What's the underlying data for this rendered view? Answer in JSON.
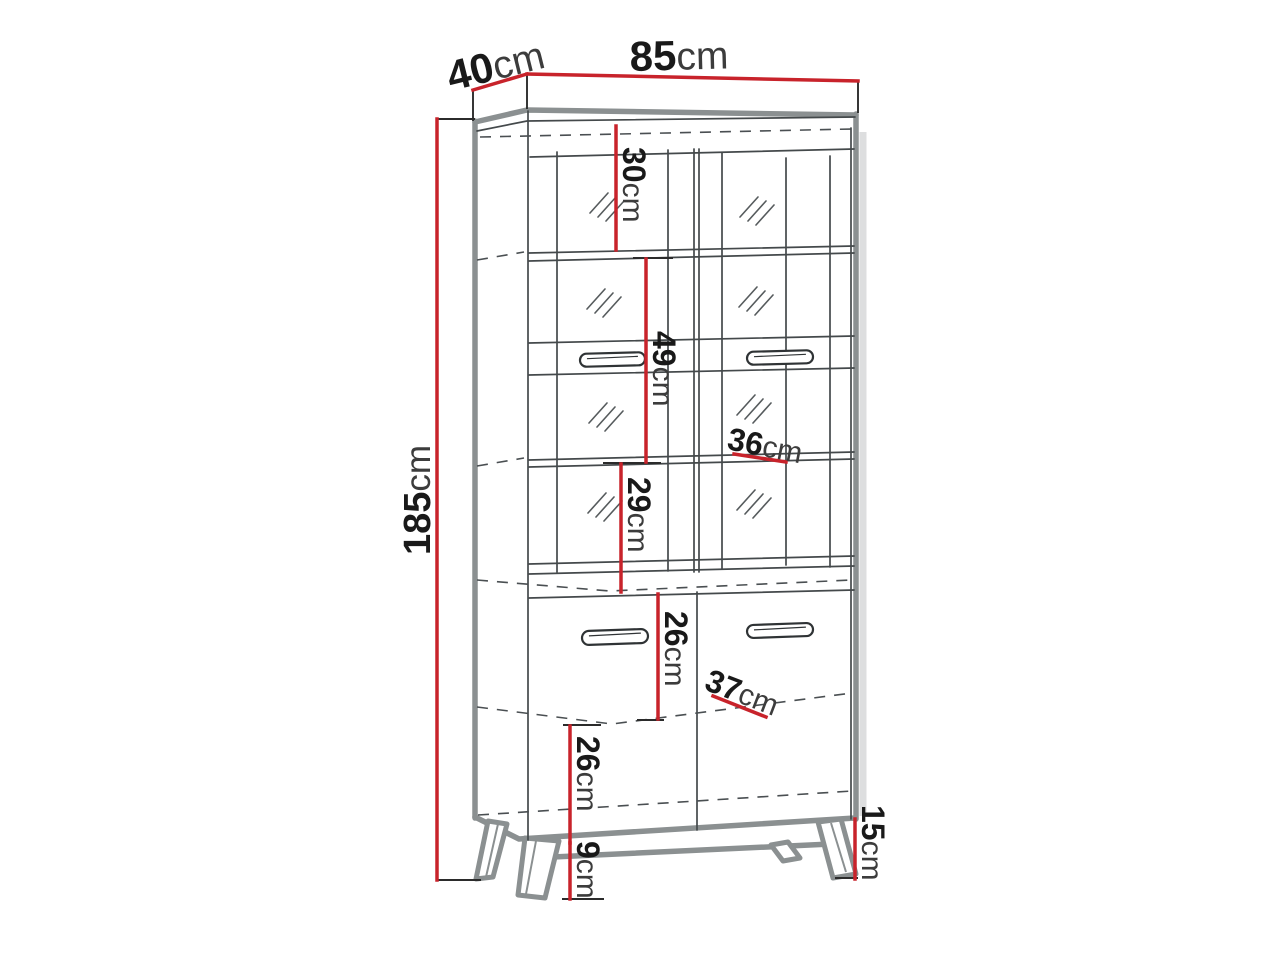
{
  "diagram": {
    "dimensions": {
      "depth_top": {
        "num": "40",
        "unit": "cm"
      },
      "width_top": {
        "num": "85",
        "unit": "cm"
      },
      "height_total": {
        "num": "185",
        "unit": "cm"
      },
      "top_compartment": {
        "num": "30",
        "unit": "cm"
      },
      "middle_compartment": {
        "num": "49",
        "unit": "cm"
      },
      "shelf_depth_upper": {
        "num": "36",
        "unit": "cm"
      },
      "lower_glass_compartment": {
        "num": "29",
        "unit": "cm"
      },
      "cabinet_upper_compartment": {
        "num": "26",
        "unit": "cm"
      },
      "shelf_depth_lower": {
        "num": "37",
        "unit": "cm"
      },
      "cabinet_lower_compartment": {
        "num": "26",
        "unit": "cm"
      },
      "leg_height": {
        "num": "9",
        "unit": "cm"
      },
      "base_height": {
        "num": "15",
        "unit": "cm"
      }
    },
    "colors": {
      "dimension_red": "#c8232b",
      "outline_gray": "#8b9091",
      "line_dark": "#3f4446",
      "text_dark": "#191919",
      "background": "#ffffff"
    }
  }
}
